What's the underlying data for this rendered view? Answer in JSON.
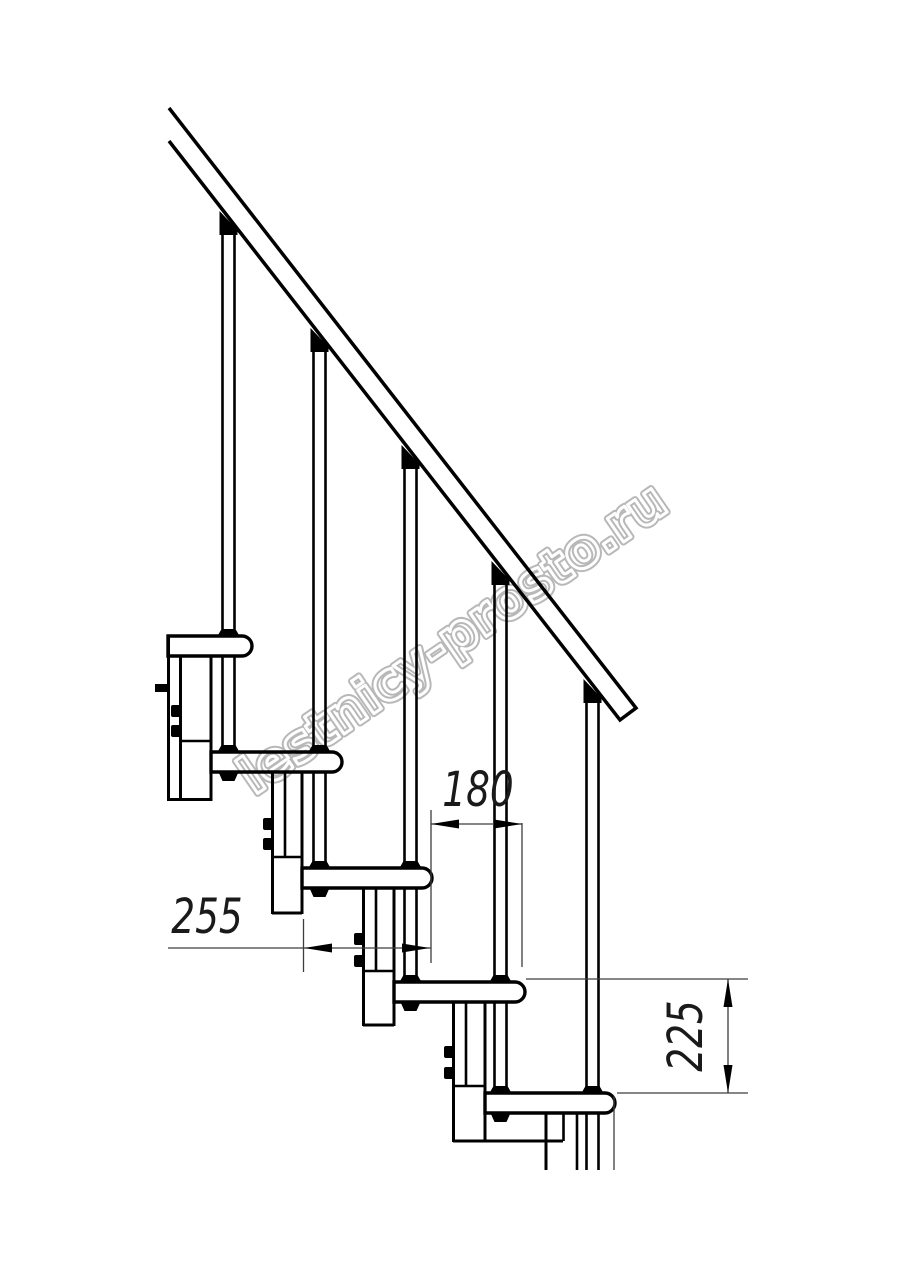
{
  "title": "Modular staircase side-view technical drawing",
  "watermark": {
    "text": "lestnicy-prosto.ru"
  },
  "dimensions": {
    "run_mm": "180",
    "tread_depth_mm": "255",
    "rise_mm": "225"
  },
  "colors": {
    "line": "#000000",
    "dim_line": "#3d3d3d",
    "watermark_outline": "#b8b8b8",
    "background": "#ffffff"
  }
}
